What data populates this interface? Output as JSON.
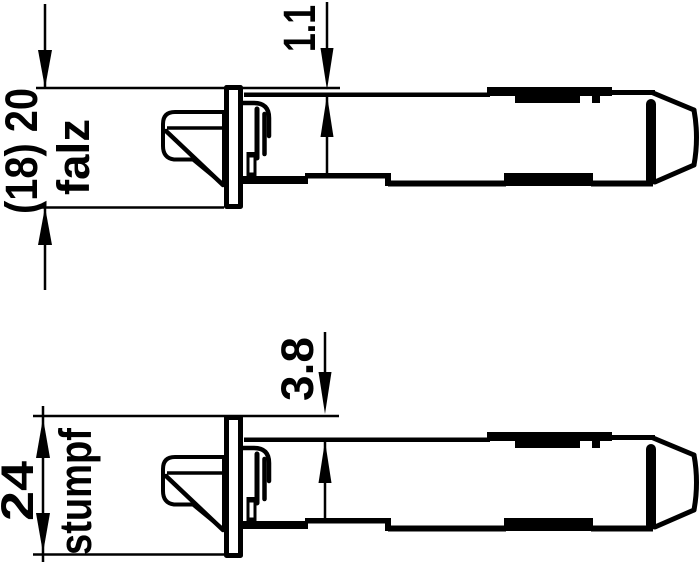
{
  "figure": {
    "type": "technical-drawing",
    "background_color": "#ffffff",
    "line_color": "#000000",
    "views": [
      {
        "name": "falz",
        "height_dimension": "(18) 20",
        "door_type_label": "falz",
        "offset_dimension": "1.1"
      },
      {
        "name": "stumpf",
        "height_dimension": "24",
        "door_type_label": "stumpf",
        "offset_dimension": "3.8"
      }
    ]
  }
}
